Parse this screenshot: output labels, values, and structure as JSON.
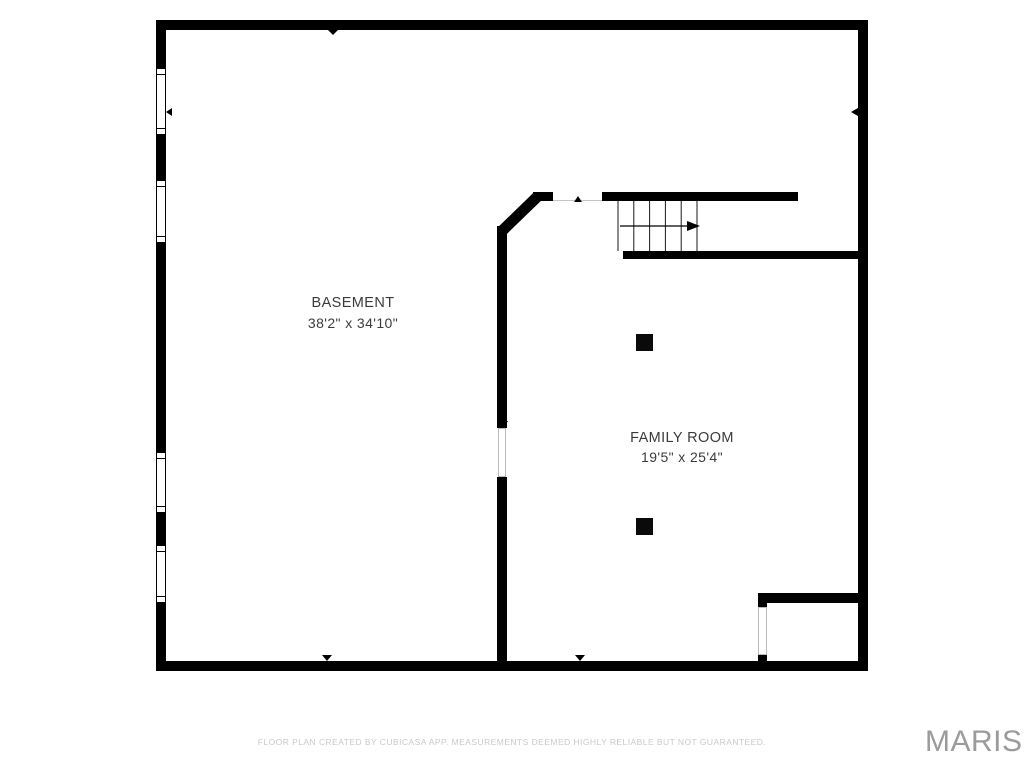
{
  "title": "Basement floor plan",
  "rooms": [
    {
      "name": "BASEMENT",
      "dimensions": "38'2\" x 34'10\""
    },
    {
      "name": "FAMILY ROOM",
      "dimensions": "19'5\" x 25'4\""
    }
  ],
  "footer": {
    "disclaimer": "FLOOR PLAN CREATED BY CUBICASA APP. MEASUREMENTS DEEMED HIGHLY RELIABLE BUT NOT GUARANTEED.",
    "brand": "MARIS"
  },
  "colors": {
    "wall": "#000000",
    "label": "#3b3b3b",
    "disclaimer": "#c8c9ca",
    "brand": "#9b9b9b",
    "opening_outline": "#bbbbbb"
  },
  "icons": {
    "stair_direction": "arrow-right-icon",
    "wall_marker": "triangle-marker-icon"
  }
}
